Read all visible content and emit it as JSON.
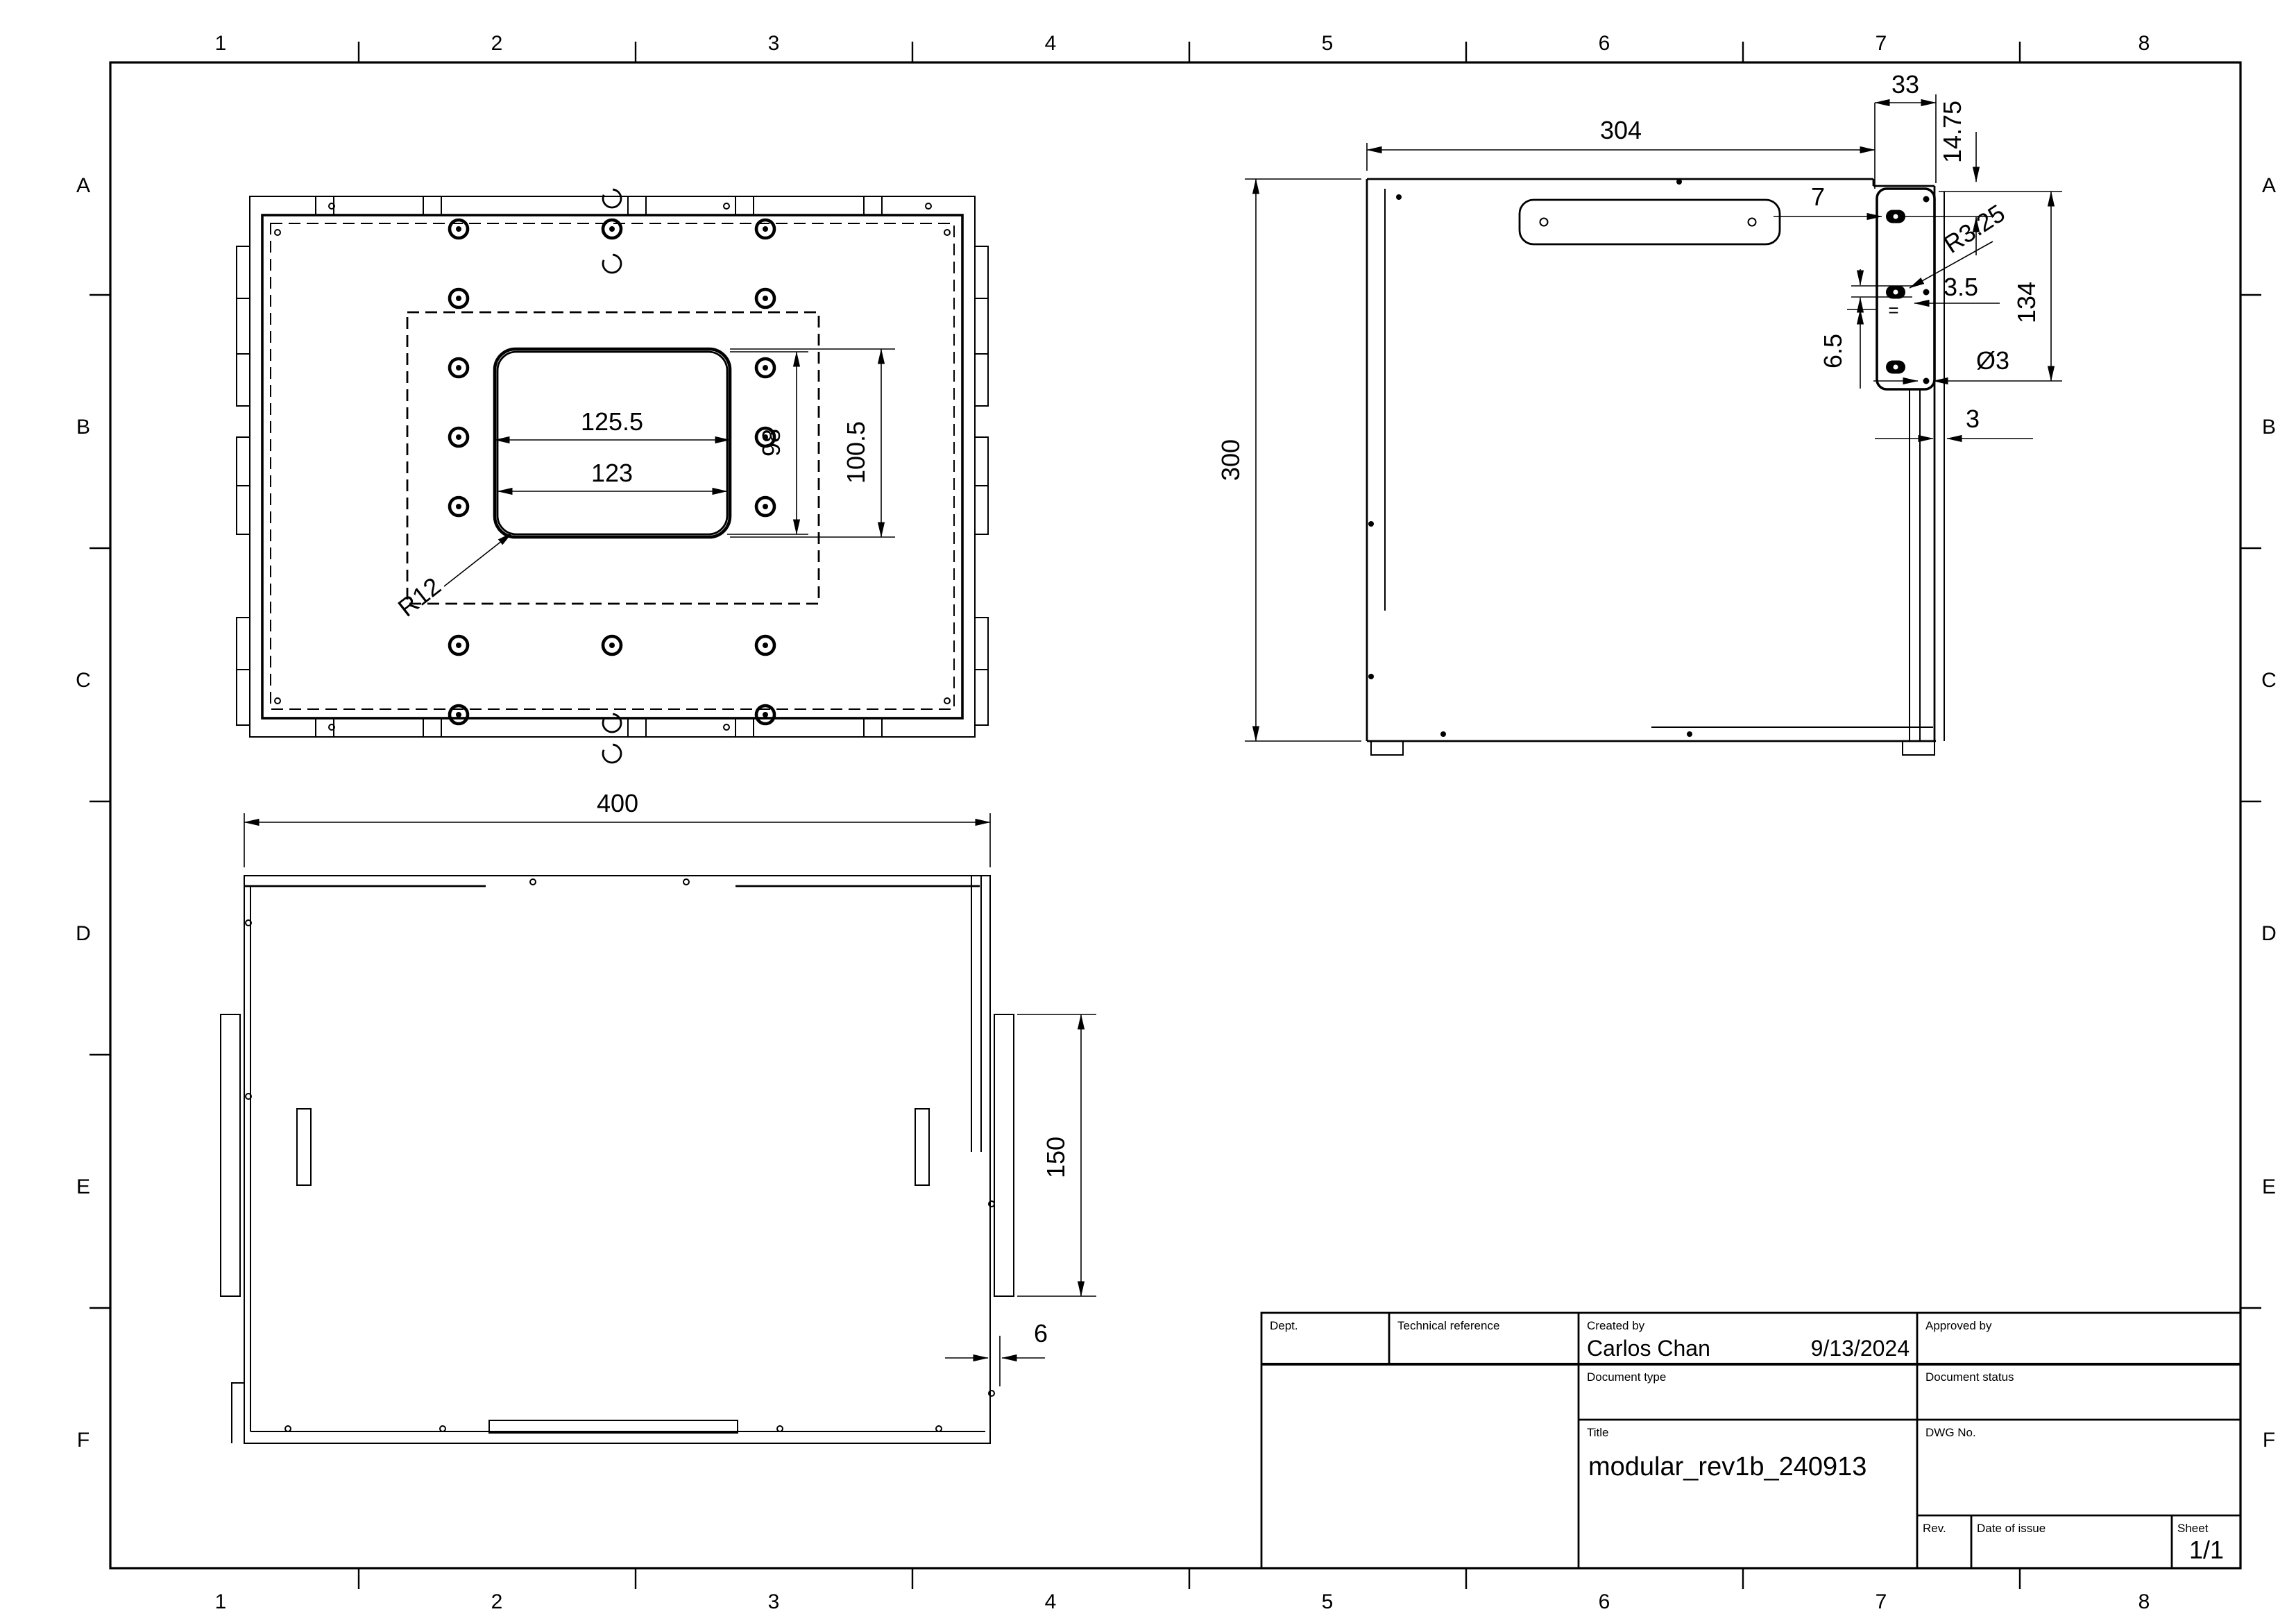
{
  "frame": {
    "columns": [
      "1",
      "2",
      "3",
      "4",
      "5",
      "6",
      "7",
      "8"
    ],
    "rows": [
      "A",
      "B",
      "C",
      "D",
      "E",
      "F"
    ]
  },
  "views": {
    "top_view": {
      "dim_outer_width": "125.5",
      "dim_inner_width": "123",
      "dim_inner_height": "98",
      "dim_outer_height": "100.5",
      "dim_corner_radius": "R12"
    },
    "side_view": {
      "dim_width": "304",
      "dim_height": "300",
      "dim_bracket_width": "33",
      "dim_hole_top_offset": "14.75",
      "dim_hole_edge_offset": "7",
      "dim_slot_radius": "R3.25",
      "dim_slot_height": "3.5",
      "dim_equal_spacing": "=",
      "dim_hole_spacing": "6.5",
      "dim_hole_span": "134",
      "dim_hole_diameter": "Ø3",
      "dim_wall_thickness": "3"
    },
    "bottom_view": {
      "dim_overall_width": "400",
      "dim_flange_length": "150",
      "dim_flange_thickness": "6"
    }
  },
  "title_block": {
    "dept_label": "Dept.",
    "technical_reference_label": "Technical reference",
    "created_by_label": "Created by",
    "created_by": "Carlos Chan",
    "created_date": "9/13/2024",
    "approved_by_label": "Approved by",
    "document_type_label": "Document type",
    "document_status_label": "Document status",
    "title_label": "Title",
    "title": "modular_rev1b_240913",
    "dwg_no_label": "DWG No.",
    "rev_label": "Rev.",
    "date_of_issue_label": "Date of issue",
    "sheet_label": "Sheet",
    "sheet": "1/1"
  }
}
